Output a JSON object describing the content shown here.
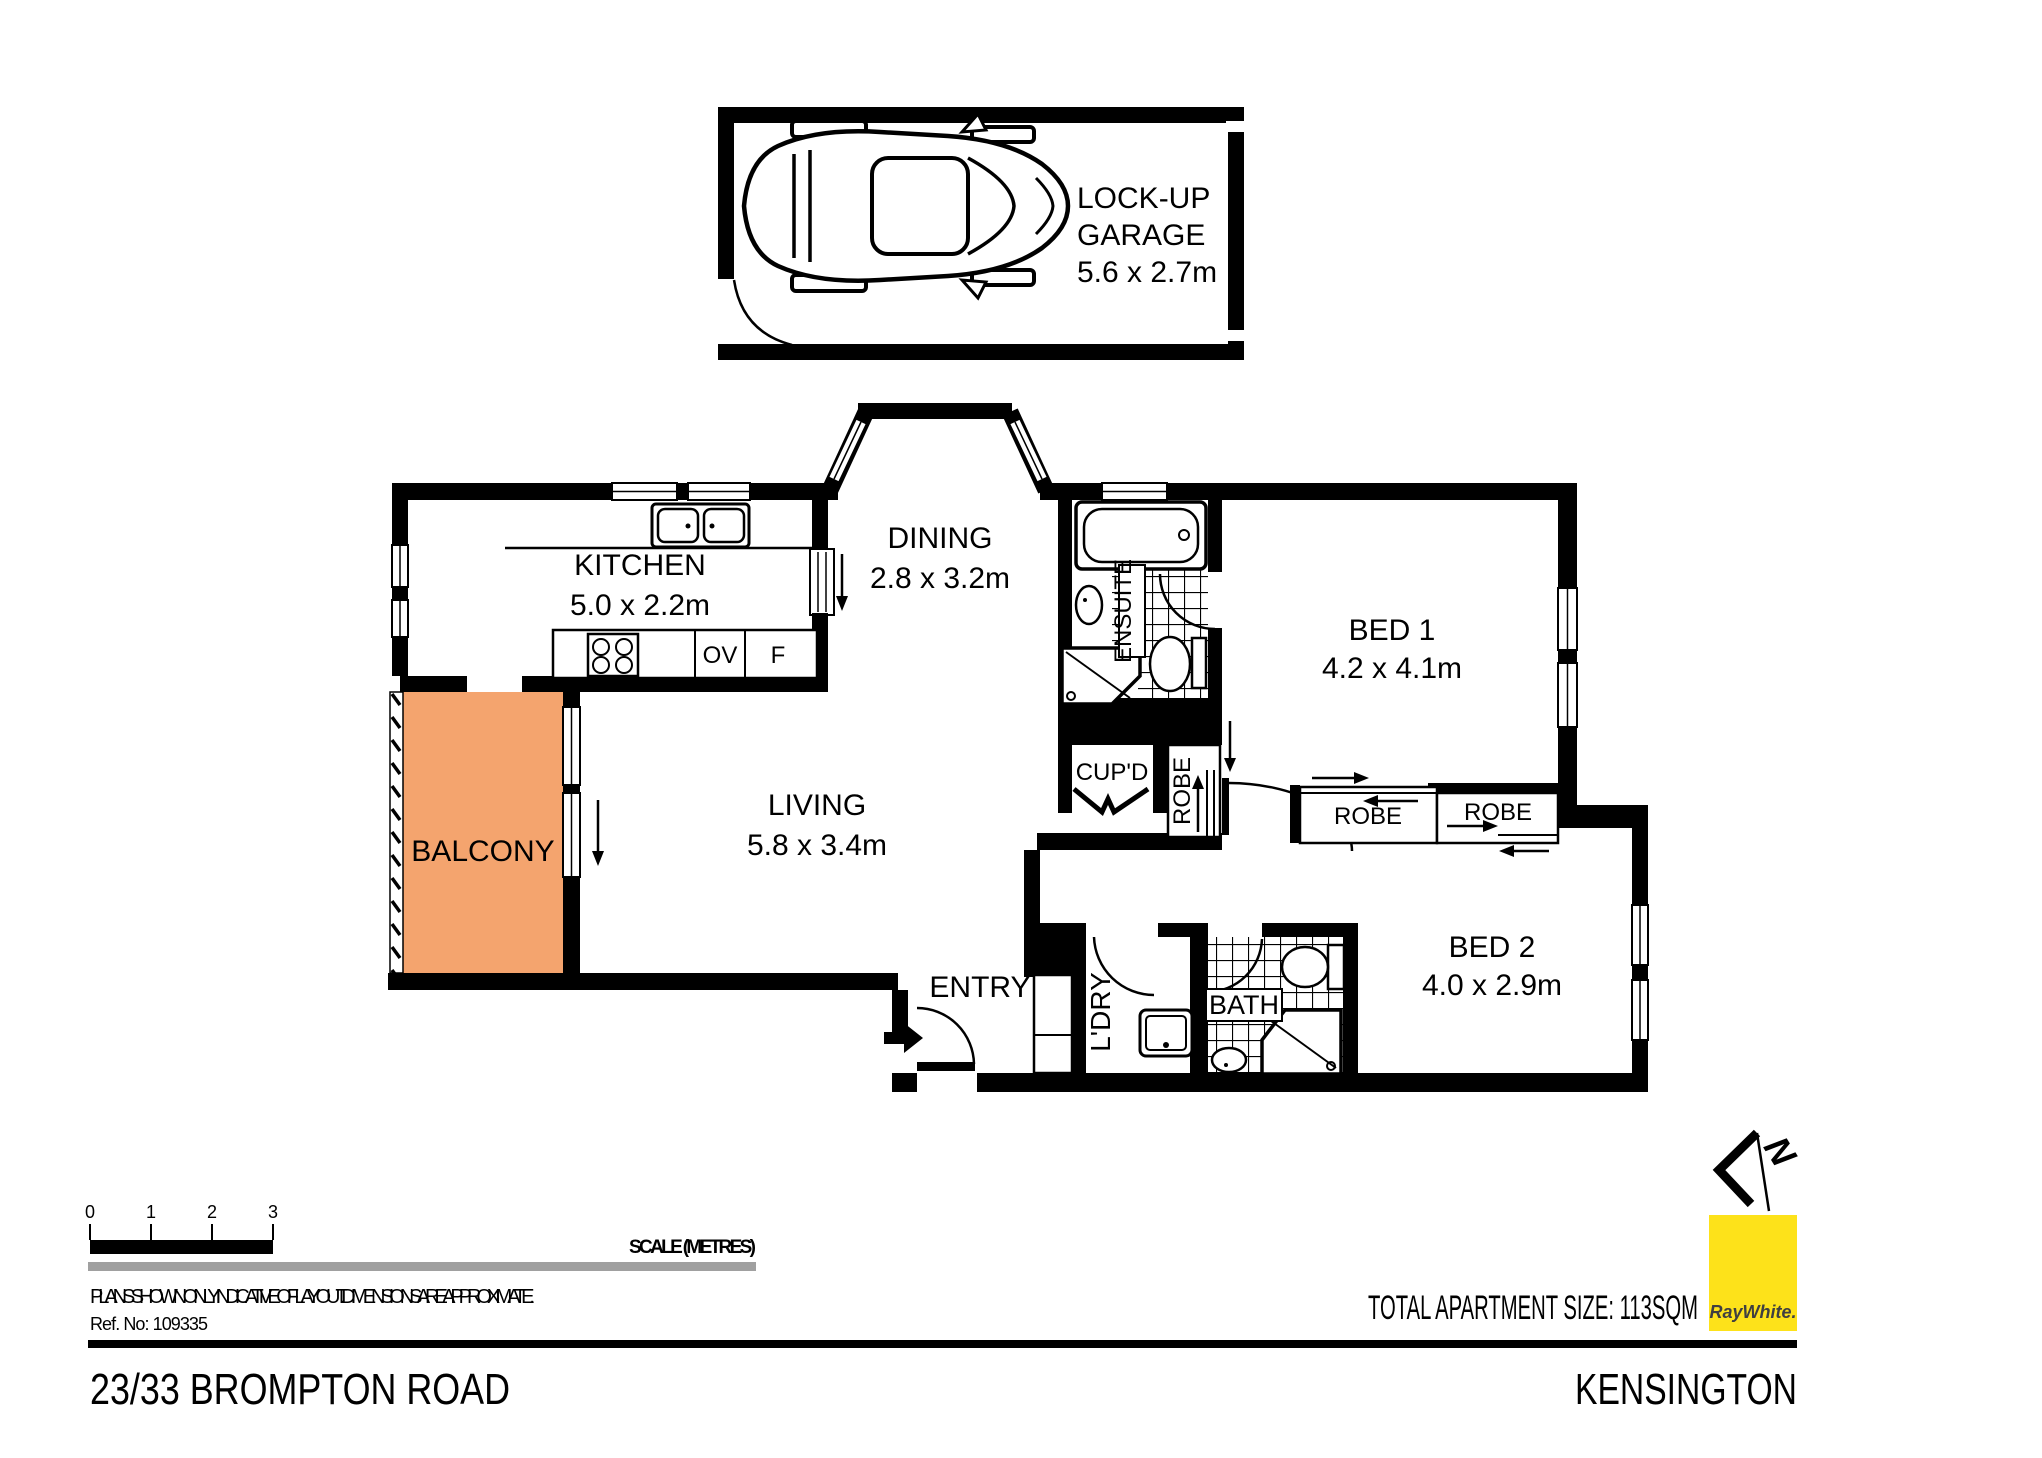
{
  "colors": {
    "balcony_fill": "#F4A46E",
    "brand_yellow": "#FDE21A",
    "summary_text": "#3A3A3C",
    "scale_bar_gray": "#A0A0A0",
    "line": "#000000"
  },
  "garage": {
    "label_line1": "LOCK-UP",
    "label_line2": "GARAGE",
    "dims": "5.6 x 2.7m"
  },
  "rooms": {
    "kitchen": {
      "name": "KITCHEN",
      "dims": "5.0 x 2.2m"
    },
    "dining": {
      "name": "DINING",
      "dims": "2.8 x 3.2m"
    },
    "living": {
      "name": "LIVING",
      "dims": "5.8 x 3.4m"
    },
    "bed1": {
      "name": "BED 1",
      "dims": "4.2 x 4.1m"
    },
    "bed2": {
      "name": "BED 2",
      "dims": "4.0 x 2.9m"
    },
    "balcony": {
      "name": "BALCONY"
    },
    "entry": {
      "name": "ENTRY"
    },
    "ensuite": {
      "name": "ENSUITE"
    },
    "bath": {
      "name": "BATH"
    },
    "laundry": {
      "name": "L'DRY"
    },
    "cupboard": {
      "name": "CUP'D"
    },
    "robe_hall": {
      "name": "ROBE"
    },
    "robe_bed1": {
      "name": "ROBE"
    },
    "robe_bed2": {
      "name": "ROBE"
    }
  },
  "appliances": {
    "oven_label": "OV",
    "fridge_label": "F"
  },
  "scale_bar": {
    "tick_labels": [
      "0",
      "1",
      "2",
      "3"
    ],
    "title": "SCALE (METRES)"
  },
  "notes": {
    "disclaimer": "PLANS SHOWN ONLY INDICATIVE OF LAYOUT.  DIMENSIONS ARE APPROXIMATE.",
    "reference": "Ref. No: 109335"
  },
  "summary": {
    "total_size": "TOTAL APARTMENT SIZE: 113SQM"
  },
  "branding": {
    "agency": "RayWhite."
  },
  "compass": {
    "north_label": "N"
  },
  "footer": {
    "address": "23/33 BROMPTON ROAD",
    "suburb": "KENSINGTON"
  }
}
